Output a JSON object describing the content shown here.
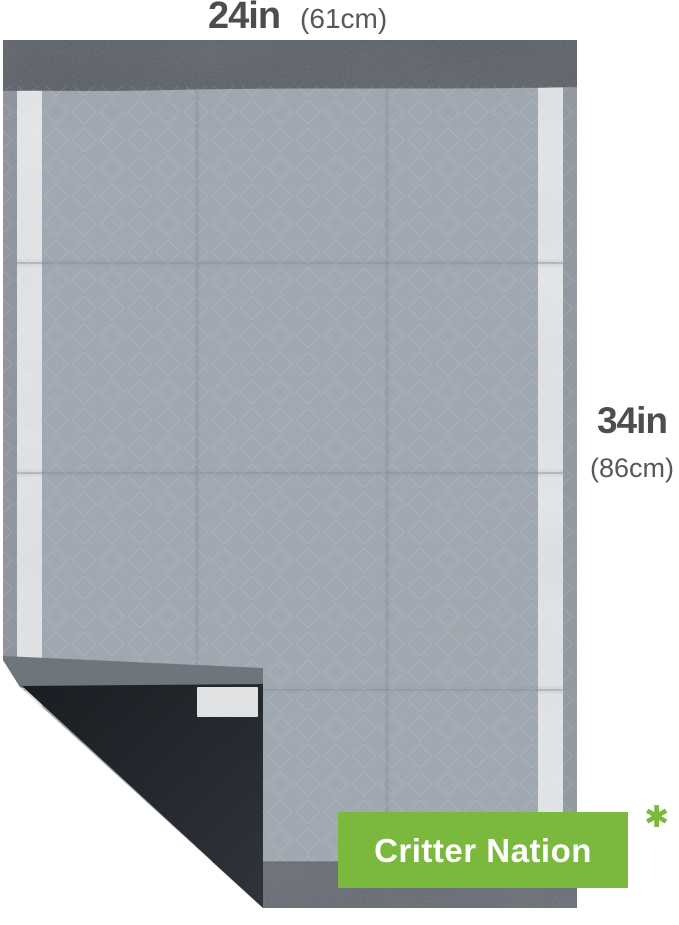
{
  "dimensions": {
    "width": {
      "value": "24in",
      "metric": "(61cm)"
    },
    "height": {
      "value": "34in",
      "metric": "(86cm)"
    }
  },
  "brand_badge": {
    "label": "Critter Nation",
    "footnote_marker": "✱",
    "background_color": "#7bb83e",
    "text_color": "#ffffff"
  },
  "pad_colors": {
    "surface": "#9aa2ab",
    "top_edge_band": "#53585e",
    "bottom_edge_band": "#5e636a",
    "side_edge": "#868d96",
    "adhesive_release_strip": "#e5e7e9",
    "folded_corner_backing": "#1a1e23",
    "corner_tape": "#dfe1e3"
  },
  "label_colors": {
    "dimension_primary": "#4b4d4f",
    "dimension_secondary": "#58585a"
  }
}
